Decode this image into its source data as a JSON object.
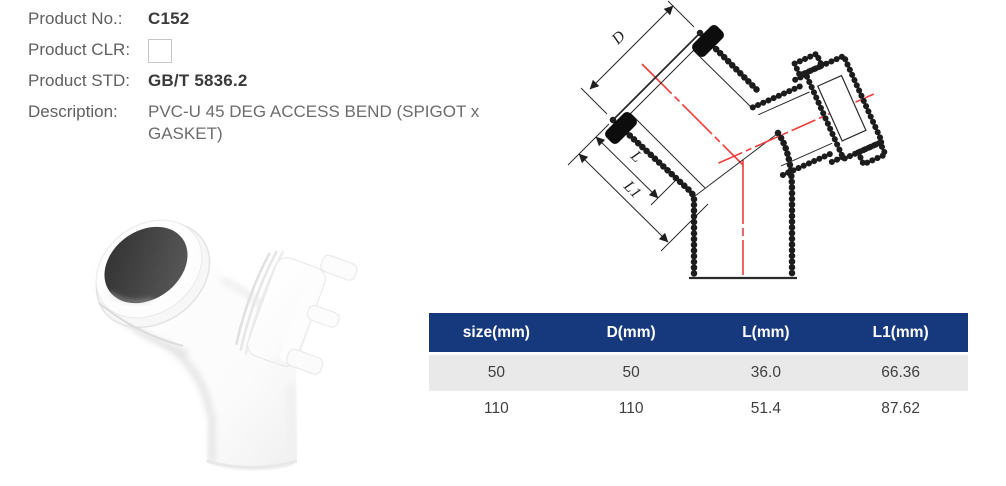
{
  "product": {
    "no_label": "Product No.:",
    "no_value": "C152",
    "clr_label": "Product CLR:",
    "std_label": "Product STD:",
    "std_value": "GB/T 5836.2",
    "desc_label": "Description:",
    "desc_value": "PVC-U 45 DEG ACCESS BEND (SPIGOT x GASKET)"
  },
  "drawing": {
    "labels": {
      "d": "D",
      "l": "L",
      "l1": "L1"
    },
    "centerline_color": "#f03b3b",
    "line_color": "#1f1f1f"
  },
  "table": {
    "columns": [
      "size(mm)",
      "D(mm)",
      "L(mm)",
      "L1(mm)"
    ],
    "rows": [
      [
        "50",
        "50",
        "36.0",
        "66.36"
      ],
      [
        "110",
        "110",
        "51.4",
        "87.62"
      ]
    ],
    "header_bg": "#16387d",
    "header_text_color": "#ffffff",
    "row_alt_bg": "#e9e9e9"
  }
}
